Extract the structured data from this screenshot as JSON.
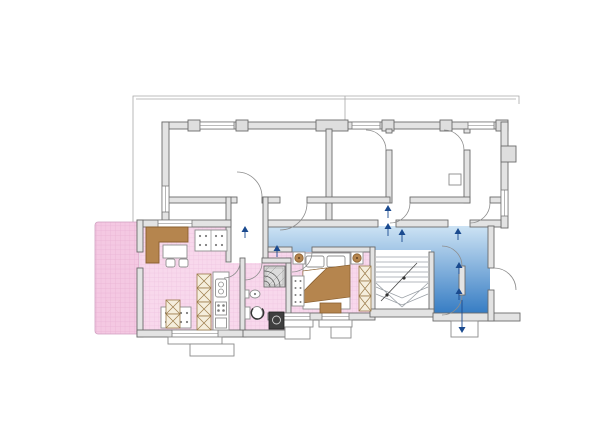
{
  "plan": {
    "title": "apartment floor plan",
    "colors": {
      "background": "#ffffff",
      "apartment_pink": "#f8d8ec",
      "apartment_grid": "#efc5e0",
      "terrace_pink": "#f4c8e2",
      "terrace_grid": "#e9b2d4",
      "hall_blue_top": "#cde3f4",
      "hall_blue_bottom": "#2e77c1",
      "wall_fill": "#e3e3e3",
      "wall_stroke": "#6b6b6b",
      "door_arc": "#8d8d8d",
      "furniture_wood": "#b5854e",
      "furniture_wood_dark": "#8a6030",
      "cabinet_cream": "#f5eedd",
      "arrow_blue": "#1a4a8f",
      "appliance_dark": "#3f3f3f"
    },
    "regions": [
      {
        "name": "terrace",
        "kind": "outdoor-terrace",
        "highlighted": true,
        "color_key": "terrace_pink"
      },
      {
        "name": "apartment-living-dining",
        "kind": "room",
        "highlighted": true,
        "color_key": "apartment_pink"
      },
      {
        "name": "apartment-bathroom",
        "kind": "room",
        "highlighted": true,
        "color_key": "apartment_pink"
      },
      {
        "name": "apartment-bedroom",
        "kind": "room",
        "highlighted": true,
        "color_key": "apartment_pink"
      },
      {
        "name": "entry-vestibule",
        "kind": "room",
        "highlighted": false
      },
      {
        "name": "common-hall",
        "kind": "circulation",
        "highlighted": true,
        "color_key": "hall_blue_top"
      },
      {
        "name": "stairwell",
        "kind": "stairs",
        "highlighted": false
      },
      {
        "name": "upper-room-1",
        "kind": "room",
        "highlighted": false
      },
      {
        "name": "upper-room-2",
        "kind": "room",
        "highlighted": false
      },
      {
        "name": "upper-room-3",
        "kind": "room",
        "highlighted": false
      },
      {
        "name": "upper-room-4",
        "kind": "room",
        "highlighted": false
      },
      {
        "name": "entrance-porch",
        "kind": "exterior-step",
        "highlighted": false
      }
    ],
    "furniture": [
      {
        "name": "l-shaped-desk",
        "room": "apartment-living-dining"
      },
      {
        "name": "dining-table-chairs",
        "room": "apartment-living-dining"
      },
      {
        "name": "sofa-upper",
        "room": "apartment-living-dining"
      },
      {
        "name": "sofa-lower",
        "room": "apartment-living-dining"
      },
      {
        "name": "crosshatch-cabinet-small",
        "room": "apartment-living-dining"
      },
      {
        "name": "crosshatch-cabinet-tall",
        "room": "apartment-living-dining"
      },
      {
        "name": "kitchen-counter",
        "room": "apartment-living-dining"
      },
      {
        "name": "shower",
        "room": "apartment-bathroom"
      },
      {
        "name": "washing-machine",
        "room": "apartment-bathroom"
      },
      {
        "name": "sink",
        "room": "apartment-bathroom"
      },
      {
        "name": "toilet",
        "room": "apartment-bathroom"
      },
      {
        "name": "double-bed",
        "room": "apartment-bedroom"
      },
      {
        "name": "nightstand-left",
        "room": "apartment-bedroom"
      },
      {
        "name": "nightstand-right",
        "room": "apartment-bedroom"
      },
      {
        "name": "dresser",
        "room": "apartment-bedroom"
      },
      {
        "name": "wardrobe",
        "room": "apartment-bedroom"
      },
      {
        "name": "bench",
        "room": "apartment-bedroom"
      }
    ],
    "symbols": {
      "entry_arrows": 9,
      "door_swings": 12,
      "windows": 9,
      "stair_direction": "up"
    }
  }
}
